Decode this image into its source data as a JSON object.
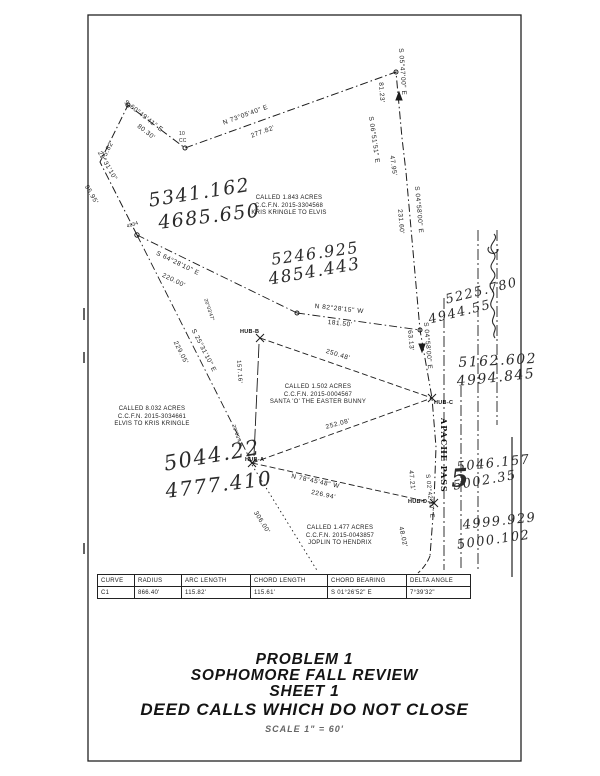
{
  "sheet": {
    "title_lines": [
      "PROBLEM 1",
      "SOPHOMORE FALL REVIEW",
      "SHEET 1",
      "DEED CALLS WHICH DO NOT CLOSE"
    ],
    "scale_note": "SCALE 1\" = 60'"
  },
  "street": {
    "name": "APACHE PASS"
  },
  "parcels": {
    "northeast": {
      "l1": "CALLED 1.843 ACRES",
      "l2": "C.C.F.N. 2015-3304568",
      "l3": "KRIS KRINGLE TO ELVIS"
    },
    "west": {
      "l1": "CALLED 8.032 ACRES",
      "l2": "C.C.F.N. 2015-3034661",
      "l3": "ELVIS TO KRIS KRINGLE"
    },
    "center": {
      "l1": "CALLED 1.502 ACRES",
      "l2": "C.C.F.N. 2015-0004567",
      "l3": "SANTA 'O' THE EASTER BUNNY"
    },
    "south": {
      "l1": "CALLED 1.477 ACRES",
      "l2": "C.C.F.N. 2015-0043857",
      "l3": "JOPLIN TO HENDRIX"
    }
  },
  "lines": [
    {
      "bearing": "S 60°49'41\" E",
      "distance": "80.30'"
    },
    {
      "distance": "75.82'"
    },
    {
      "bearing": "25°31'10\"",
      "distance": "95.95'"
    },
    {
      "bearing": "N 73°05'40\" E",
      "distance": "277.82'"
    },
    {
      "bearing": "S 05°47'00\" E",
      "distance": "81.23'"
    },
    {
      "bearing": "S 06°51'51\" E",
      "distance": "47.95'"
    },
    {
      "bearing": "S 04°58'00\" E",
      "distance": "231.60'"
    },
    {
      "bearing": "S 64°28'10\" E",
      "distance": "220.00'"
    },
    {
      "bearing": "S 25°31'10\" E",
      "distance": "229.05'"
    },
    {
      "bearing": "N 82°28'15\" W",
      "distance": "181.50'"
    },
    {
      "distance": "250.48'"
    },
    {
      "distance": "252.08'"
    },
    {
      "bearing": "S 04°58'00\" E",
      "distance": "63.13'"
    },
    {
      "bearing": "N 78°45'48\" W",
      "distance": "226.94'"
    },
    {
      "distance": "306.00'"
    },
    {
      "distance": "47.21'"
    },
    {
      "bearing": "S 02°42'30\" E"
    },
    {
      "distance": "48.02'"
    },
    {
      "distance": "157.16'"
    }
  ],
  "points": {
    "hub_a": "HUB-A",
    "hub_b": "HUB-B",
    "hub_c": "HUB-C",
    "hub_d": "HUB-D",
    "pt10": "10",
    "ptcc": "CC",
    "pt4834": "4834",
    "small_note": "20°03'47\""
  },
  "handwritten": {
    "pairs": [
      {
        "n": "5341.162",
        "e": "4685.650"
      },
      {
        "n": "5246.925",
        "e": "4854.443"
      },
      {
        "n": "5225.780",
        "e": "4944.55"
      },
      {
        "n": "5162.602",
        "e": "4994.845"
      },
      {
        "n": "5044.22",
        "e": "4777.410"
      },
      {
        "n": "5046.157",
        "e": "5002.35"
      },
      {
        "n": "4999.929",
        "e": "5000.102"
      }
    ],
    "big_five": "5"
  },
  "curve_table": {
    "headers": [
      "CURVE",
      "RADIUS",
      "ARC LENGTH",
      "CHORD LENGTH",
      "CHORD BEARING",
      "DELTA ANGLE"
    ],
    "rows": [
      [
        "C1",
        "866.40'",
        "115.82'",
        "115.61'",
        "S 01°26'52\" E",
        "7°39'32\""
      ]
    ]
  },
  "colors": {
    "ink": "#1c1c1c",
    "paper": "#ffffff"
  }
}
